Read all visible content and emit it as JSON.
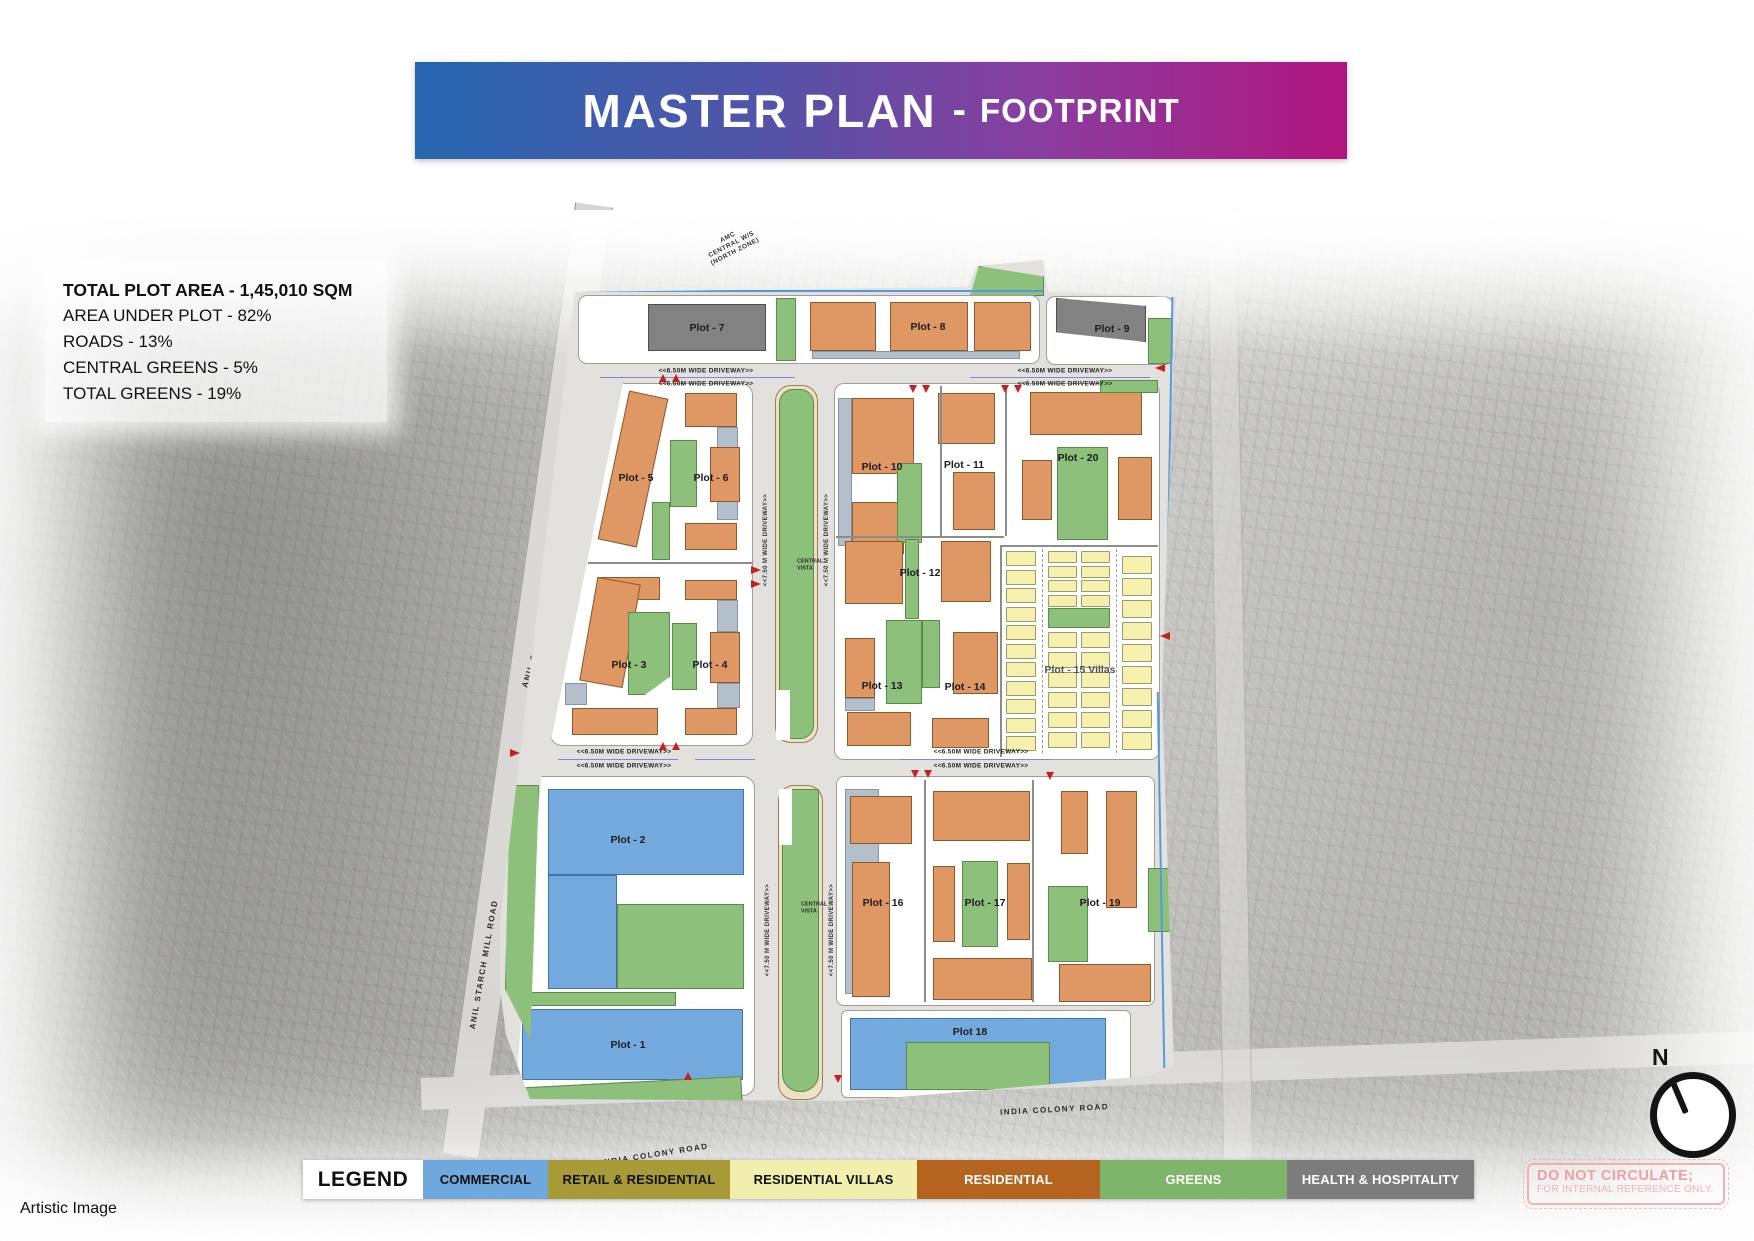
{
  "title": {
    "main": "MASTER PLAN",
    "separator": "-",
    "sub": "FOOTPRINT"
  },
  "stats": {
    "total_plot_area": "TOTAL PLOT AREA - 1,45,010 SQM",
    "area_under_plot": "AREA UNDER PLOT - 82%",
    "roads": "ROADS - 13%",
    "central_greens": "CENTRAL GREENS - 5%",
    "total_greens": "TOTAL GREENS - 19%"
  },
  "map": {
    "plots": {
      "p1": "Plot - 1",
      "p2": "Plot - 2",
      "p3": "Plot - 3",
      "p4": "Plot - 4",
      "p5": "Plot - 5",
      "p6": "Plot - 6",
      "p7": "Plot - 7",
      "p8": "Plot - 8",
      "p9": "Plot - 9",
      "p10": "Plot - 10",
      "p11": "Plot - 11",
      "p12": "Plot - 12",
      "p13": "Plot - 13",
      "p14": "Plot - 14",
      "p15": "Plot - 15 Villas",
      "p16": "Plot - 16",
      "p17": "Plot - 17",
      "p18": "Plot 18",
      "p19": "Plot - 19",
      "p20": "Plot - 20"
    },
    "driveway_h": "<<6.50M WIDE DRIVEWAY>>",
    "driveway_v": "<<7.50 M WIDE DRIVEWAY>>",
    "central_vista_line1": "CENTRAL",
    "central_vista_line2": "VISTA",
    "roads": {
      "anil_starch_mill": "ANIL STARCH MILL ROAD",
      "india_colony": "INDIA COLONY ROAD",
      "amc_line1": "AMC",
      "amc_line2": "CENTRAL W/S",
      "amc_line3": "(NORTH ZONE)"
    },
    "compass_n": "N"
  },
  "legend": {
    "title": "LEGEND",
    "items": [
      {
        "label": "COMMERCIAL",
        "color": "#6fa8dc",
        "text": "#111111",
        "width": 125
      },
      {
        "label": "RETAIL & RESIDENTIAL",
        "color": "#a89a36",
        "text": "#111111",
        "width": 182
      },
      {
        "label": "RESIDENTIAL VILLAS",
        "color": "#f2efae",
        "text": "#111111",
        "width": 187
      },
      {
        "label": "RESIDENTIAL",
        "color": "#b5641f",
        "text": "#ffffff",
        "width": 183
      },
      {
        "label": "GREENS",
        "color": "#7eb56a",
        "text": "#ffffff",
        "width": 187
      },
      {
        "label": "HEALTH & HOSPITALITY",
        "color": "#7c7c7c",
        "text": "#ffffff",
        "width": 187
      }
    ]
  },
  "stamp": {
    "line1": "DO NOT CIRCULATE;",
    "line2": "FOR INTERNAL REFERENCE ONLY."
  },
  "footer": {
    "note": "Artistic Image"
  },
  "colors": {
    "banner_start": "#2767b0",
    "banner_end": "#b0157f",
    "commercial": "#74a9dd",
    "residential": "#df9763",
    "villas": "#f5f0ae",
    "greens": "#8dc07a",
    "gray_building": "#828282",
    "road": "#e3e1dd"
  }
}
